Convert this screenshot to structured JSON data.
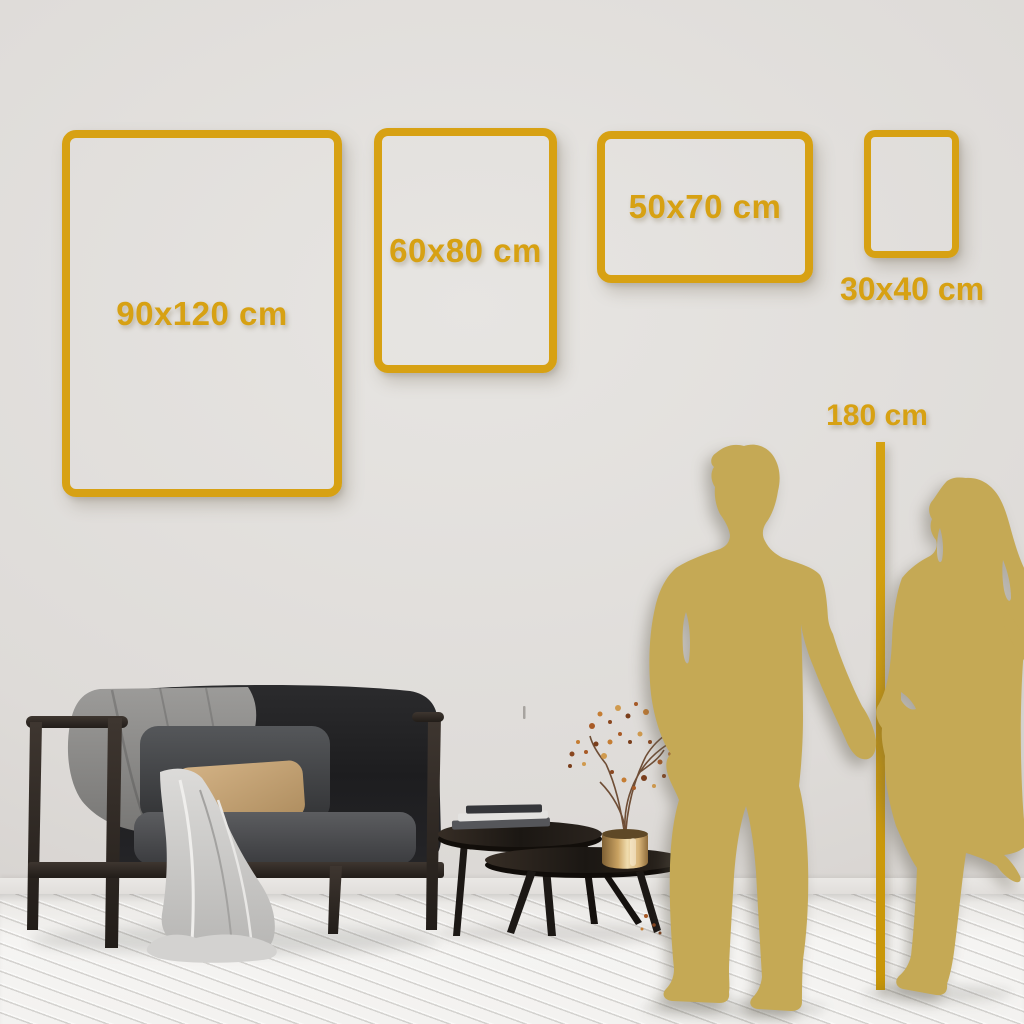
{
  "colors": {
    "accent_gold": "#D7A113",
    "ruler_gold": "#CE9B10",
    "silhouette_gold": "#C5A955",
    "wall_grey": "#DEDBD8",
    "floor_white": "#F3F2F0"
  },
  "size_frames": [
    {
      "label": "90x120 cm",
      "width_cm": 90,
      "height_cm": 120,
      "orientation": "portrait"
    },
    {
      "label": "60x80 cm",
      "width_cm": 60,
      "height_cm": 80,
      "orientation": "portrait"
    },
    {
      "label": "50x70 cm",
      "width_cm": 50,
      "height_cm": 70,
      "orientation": "landscape"
    },
    {
      "label": "30x40 cm",
      "width_cm": 30,
      "height_cm": 40,
      "orientation": "portrait"
    }
  ],
  "height_reference": {
    "label": "180 cm",
    "height_cm": 180
  },
  "scene_objects": [
    "man-silhouette",
    "woman-silhouette",
    "sofa",
    "throw-blanket",
    "coffee-tables",
    "vase-with-dried-flowers"
  ]
}
